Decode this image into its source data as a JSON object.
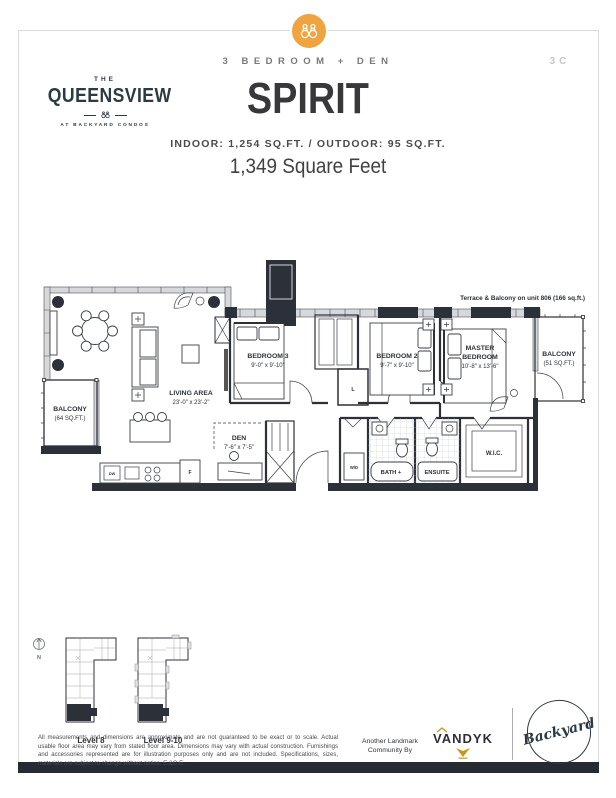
{
  "page": {
    "unit_code": "3C",
    "type_label": "3 BEDROOM + DEN",
    "unit_name": "SPIRIT",
    "area_line": "INDOOR: 1,254 SQ.FT. / OUTDOOR: 95 SQ.FT.",
    "total_area": "1,349 Square Feet"
  },
  "brand": {
    "the": "THE",
    "name": "QUEENSVIEW",
    "tagline": "AT BACKYARD CONDOS"
  },
  "plan": {
    "note": "Terrace & Balcony on unit 806 (166 sq.ft.)",
    "living": {
      "name": "LIVING AREA",
      "dims": "23'-0\" x 23'-2\""
    },
    "den": {
      "name": "DEN",
      "dims": "7'-6\" x 7'-5\""
    },
    "bedroom3": {
      "name": "BEDROOM 3",
      "dims": "9'-0\" x 9'-10\""
    },
    "bedroom2": {
      "name": "BEDROOM 2",
      "dims": "9'-7\" x 9'-10\""
    },
    "master": {
      "line1": "MASTER",
      "line2": "BEDROOM",
      "dims": "10'-8\" x 13'-6\""
    },
    "balcony_left": {
      "name": "BALCONY",
      "area": "(64 SQ.FT.)"
    },
    "balcony_right": {
      "name": "BALCONY",
      "area": "(51 SQ.FT.)"
    },
    "bath": "BATH +",
    "ensuite": "ENSUITE",
    "wic": "W.I.C.",
    "wd": "W/D",
    "linen": "L",
    "dw": "DW",
    "fridge": "F"
  },
  "keyplans": {
    "north": "N",
    "levels": [
      {
        "label": "Level 8"
      },
      {
        "label": "Level 9-10"
      }
    ]
  },
  "footer": {
    "disclaimer": "All measurements and dimensions are approximate and are not guaranteed to be exact or to scale. Actual usable floor area may vary from stated floor area. Dimensions may vary with actual construction. Furnishings and accessories represented are for illustration purposes only and are not included. Specifications, sizes, materials are subject to change without notice. E.&O.E.",
    "community_line1": "Another Landmark",
    "community_line2": "Community By",
    "vandyk": "VANDYK",
    "backyard": "Backyard"
  },
  "colors": {
    "accent_orange": "#F0A43F",
    "ink": "#2C3038",
    "frame": "#DBDBDB",
    "footer_bar": "#262A33",
    "gold": "#C9971C"
  }
}
